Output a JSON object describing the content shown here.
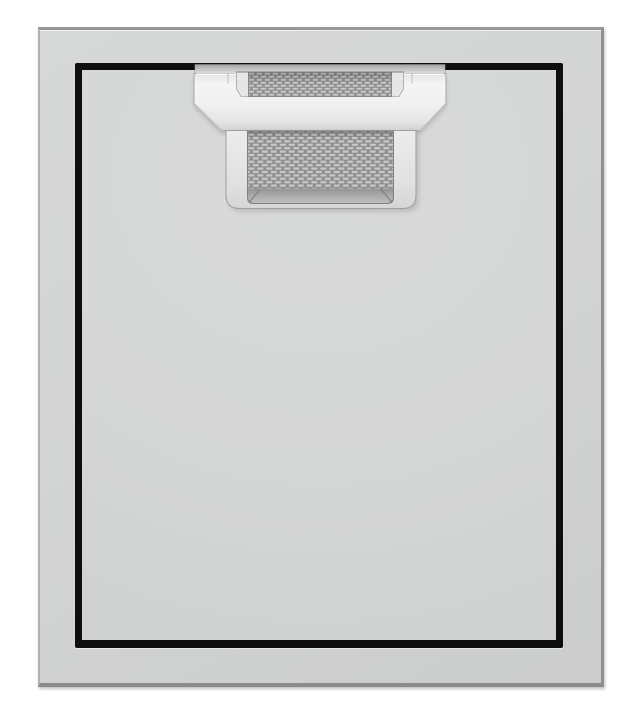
{
  "image": {
    "type": "product-photo",
    "subject": "Stainless steel single access door, front view",
    "details": {
      "frame": "flat stainless outer frame",
      "door": "flush door panel with black reveal gap outline",
      "handle": "top-center recessed handle with diamond-weave textured inserts"
    }
  },
  "colors": {
    "background": "#ffffff",
    "frame_face": "#d3d4d4",
    "frame_edge": "#909090",
    "door_face": "#d5d6d6",
    "gap_black": "#0e0e0e",
    "handle_face": "#f3f3f3",
    "handle_shade": "#d2d2d2",
    "handle_edge": "#a9a9a9",
    "mesh_base": "#8f8f8f",
    "mesh_weave": "#c8c8c8",
    "grip_face": "#e2e2e2",
    "grip_inner_face": "#9c9c9c"
  }
}
